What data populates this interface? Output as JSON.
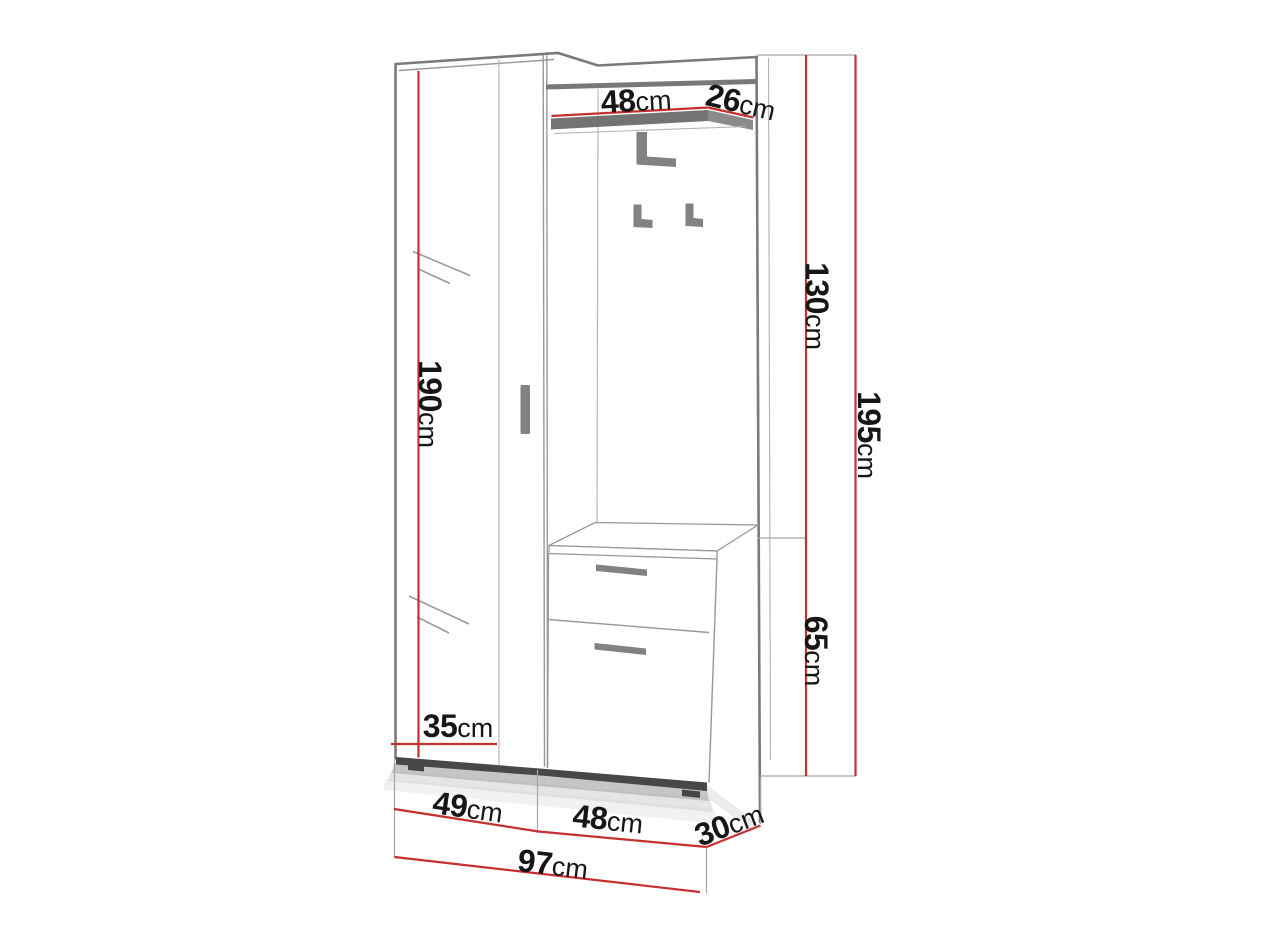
{
  "labels": {
    "shelf_width": {
      "value": "48",
      "unit": "cm"
    },
    "shelf_depth": {
      "value": "26",
      "unit": "cm"
    },
    "hook_panel_height": {
      "value": "130",
      "unit": "cm"
    },
    "total_height": {
      "value": "195",
      "unit": "cm"
    },
    "wardrobe_height": {
      "value": "190",
      "unit": "cm"
    },
    "cabinet_height": {
      "value": "65",
      "unit": "cm"
    },
    "wardrobe_depth": {
      "value": "35",
      "unit": "cm"
    },
    "wardrobe_width": {
      "value": "49",
      "unit": "cm"
    },
    "cabinet_width": {
      "value": "48",
      "unit": "cm"
    },
    "side_depth": {
      "value": "30",
      "unit": "cm"
    },
    "total_width": {
      "value": "97",
      "unit": "cm"
    }
  },
  "colors": {
    "dimension_red": "#c62f2f",
    "outline_gray": "#7a7a7a",
    "hardware_gray": "#828282",
    "shelf_edge_gray": "#737373",
    "plinth_dark": "#474747",
    "text": "#161616",
    "background": "#ffffff"
  }
}
